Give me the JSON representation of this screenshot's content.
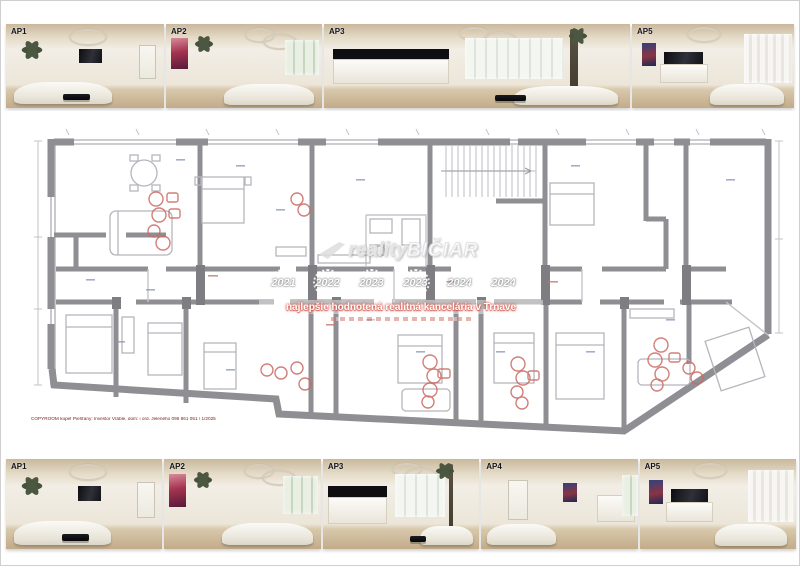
{
  "document": {
    "type": "apartment-floorplan-presentation-board"
  },
  "top_strip": {
    "photos": [
      {
        "label": "AP1",
        "variant": 1
      },
      {
        "label": "AP2",
        "variant": 2
      },
      {
        "label": "AP3",
        "variant": 3
      },
      {
        "label": "AP5",
        "variant": 5
      }
    ]
  },
  "bottom_strip": {
    "photos": [
      {
        "label": "AP1",
        "variant": 1
      },
      {
        "label": "AP2",
        "variant": 2
      },
      {
        "label": "AP3",
        "variant": 3
      },
      {
        "label": "AP4",
        "variant": 4
      },
      {
        "label": "AP5",
        "variant": 5
      }
    ]
  },
  "watermark": {
    "logo_prefix": "reality",
    "logo_suffix": "BIČIAR",
    "award_years": [
      "2021",
      "2022",
      "2023",
      "2023",
      "2024",
      "2024"
    ],
    "banner_text": "najlepšie hodnotená realitná kancelária v Trnave",
    "accent_red": "#c0392b",
    "watermark_gray": "#bdbdbd"
  },
  "plan": {
    "wall_color": "#8e8e93",
    "annotation_red": "#c96a63",
    "footer_note": "COPYROOM kúpeľ Piešťany: Investor Vráble, dom: i ord. Jeleného 096 861 051 / 1/2025"
  }
}
